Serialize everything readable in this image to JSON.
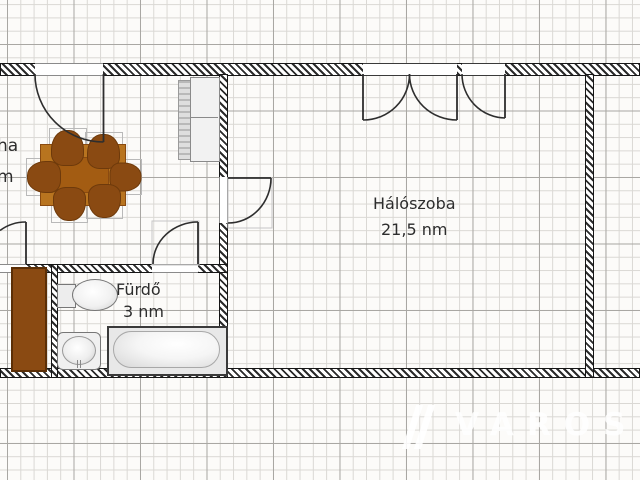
{
  "rooms": {
    "bedroom": {
      "label": "Hálószoba",
      "area": "21,5 nm"
    },
    "bathroom": {
      "label": "Fürdő",
      "area": "3 nm"
    },
    "left_room": {
      "label_fragment": "ha",
      "area_fragment": "m"
    }
  },
  "watermark": {
    "text": "VAROSI",
    "logo": "varosi-logo"
  },
  "furniture": {
    "dining_set": "dining-table-with-six-chairs",
    "wardrobe": "wardrobe-with-sliding-front",
    "tall_cabinet": "tall-brown-cabinet",
    "toilet": "toilet",
    "sink": "washbasin",
    "bathtub": "bathtub"
  },
  "colors": {
    "chair_brown": "#8a4a12",
    "table_brown": "#b8741f",
    "cabinet_brown": "#8a4a12",
    "wall_dark": "#2b2b2b",
    "grid_minor": "#dad8d4",
    "grid_major": "#a9a7a3",
    "watermark": "#ffffff"
  }
}
